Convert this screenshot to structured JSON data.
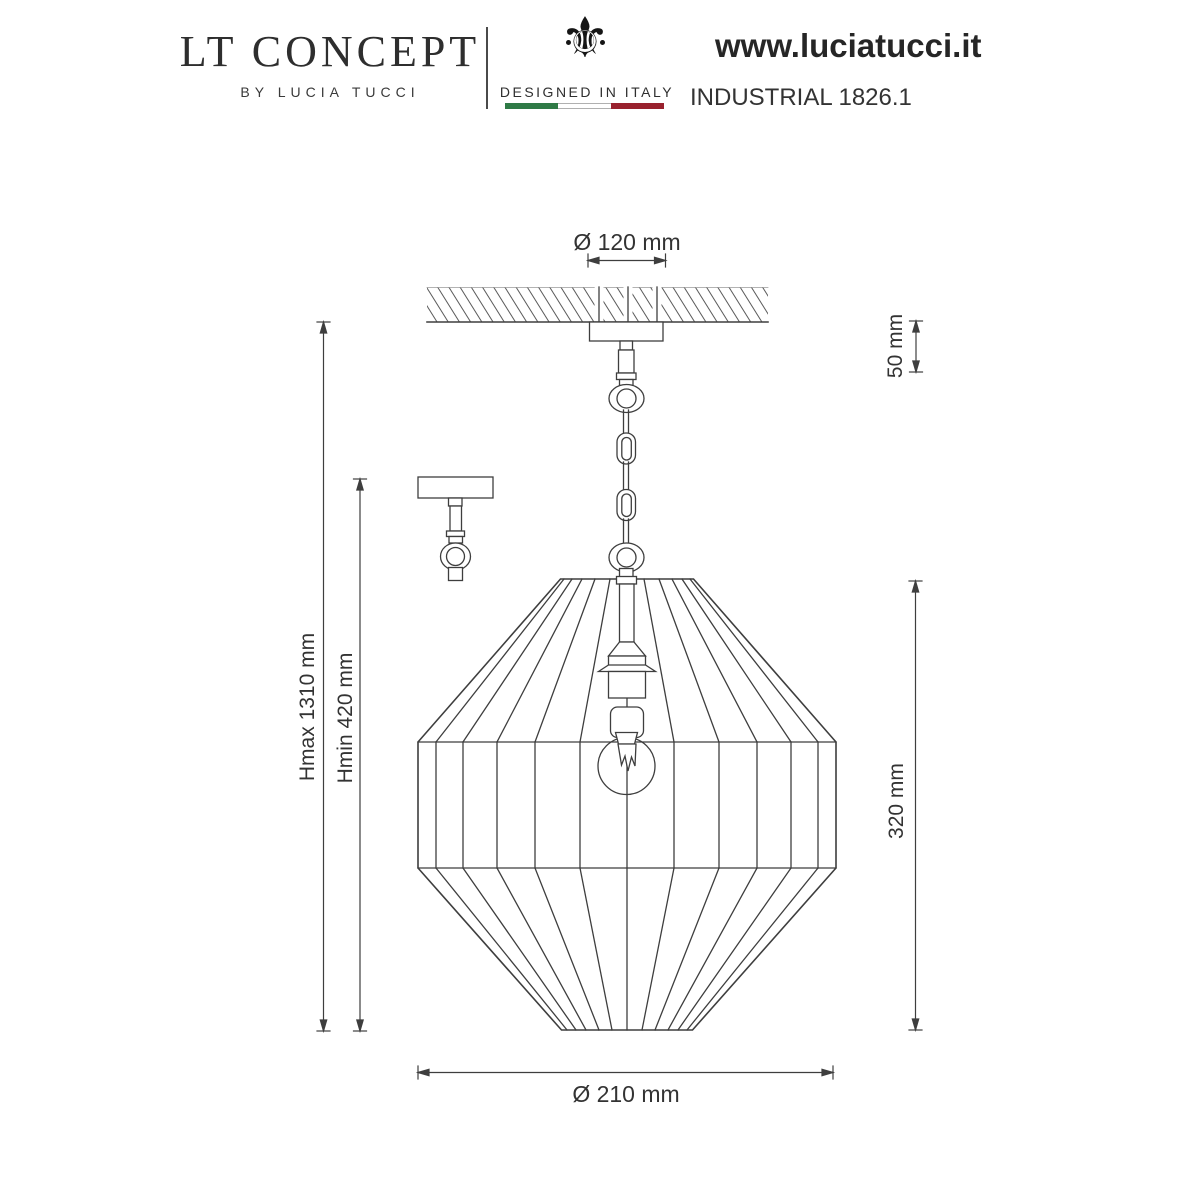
{
  "header": {
    "brand": {
      "title": "LT CONCEPT",
      "subtitle": "BY LUCIA TUCCI"
    },
    "designed_in_italy": {
      "label": "DESIGNED IN ITALY",
      "icon": "fleur-de-lis-icon",
      "icon_glyph": "⚜",
      "flag_colors": {
        "green": "#2f7a46",
        "white": "#ffffff",
        "red": "#99212e"
      }
    },
    "website": "www.luciatucci.it",
    "model": "INDUSTRIAL 1826.1"
  },
  "drawing": {
    "subject": "pendant lamp technical drawing",
    "line_color": "#3e3e3e",
    "dimensions": {
      "canopy_diameter": "Ø 120 mm",
      "canopy_height": "50 mm",
      "max_height": "Hmax 1310 mm",
      "min_height": "Hmin 420 mm",
      "shade_height": "320 mm",
      "shade_diameter": "Ø 210 mm"
    }
  }
}
